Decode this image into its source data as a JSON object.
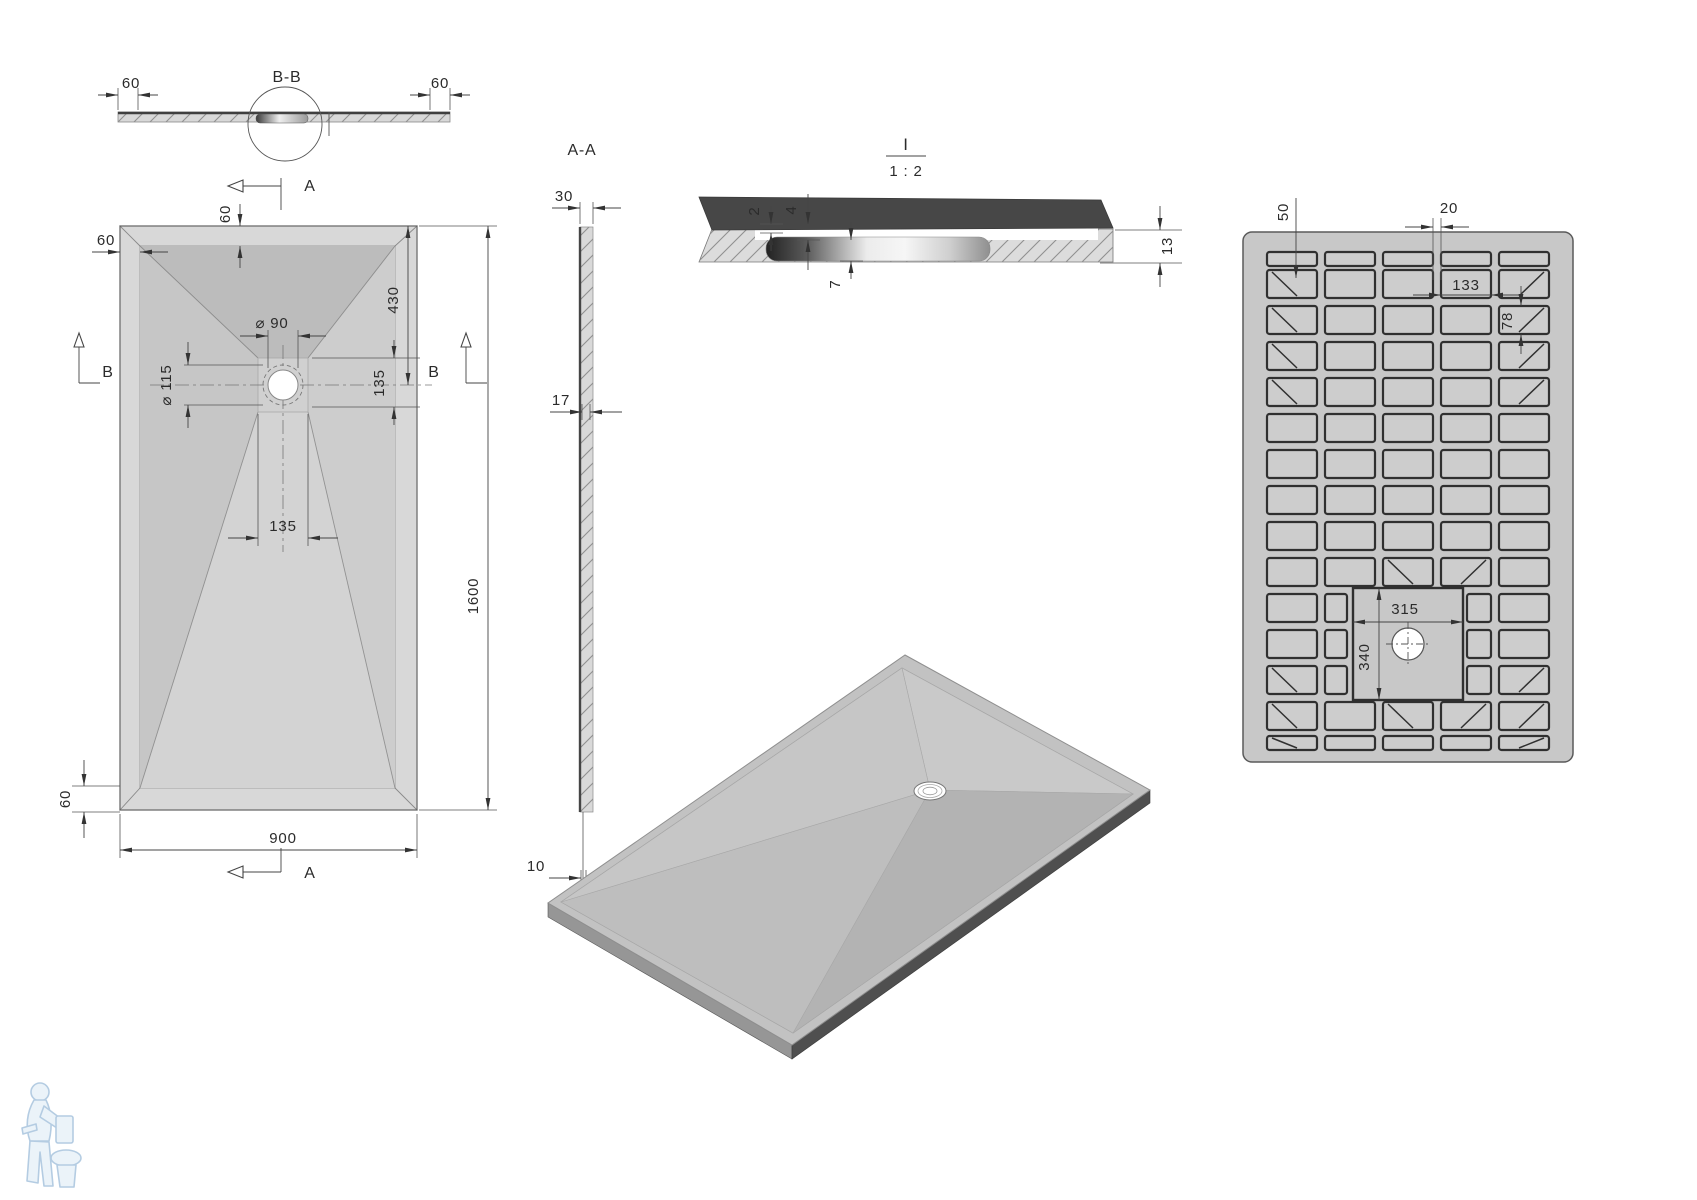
{
  "drawing": {
    "section_a_label": "A",
    "section_b_label": "B",
    "section_bb": {
      "title": "B-B",
      "dim_edge_left": "60",
      "dim_edge_right": "60"
    },
    "plan": {
      "dim_rim_left": "60",
      "dim_rim_top": "60",
      "dim_drain_from_top": "430",
      "dim_drain_diameter": "⌀ 90",
      "dim_recess_diameter": "⌀ 115",
      "dim_recess_below_center": "135",
      "dim_recess_width": "135",
      "dim_rim_bottom": "60",
      "dim_width": "900",
      "dim_length": "1600"
    },
    "section_aa": {
      "title": "A-A",
      "dim_edge_thickness": "30",
      "dim_mid_thickness": "17",
      "dim_end_thickness": "10"
    },
    "detail": {
      "title": "I",
      "scale": "1 : 2",
      "dim_lip": "2",
      "dim_step": "4",
      "dim_drain_depth": "7",
      "dim_total_thickness": "13"
    },
    "bottom_view": {
      "dim_rib_offset": "50",
      "dim_rib_gap": "20",
      "dim_cell_width": "133",
      "dim_cell_height": "78",
      "dim_center_width": "315",
      "dim_center_height": "340"
    }
  }
}
